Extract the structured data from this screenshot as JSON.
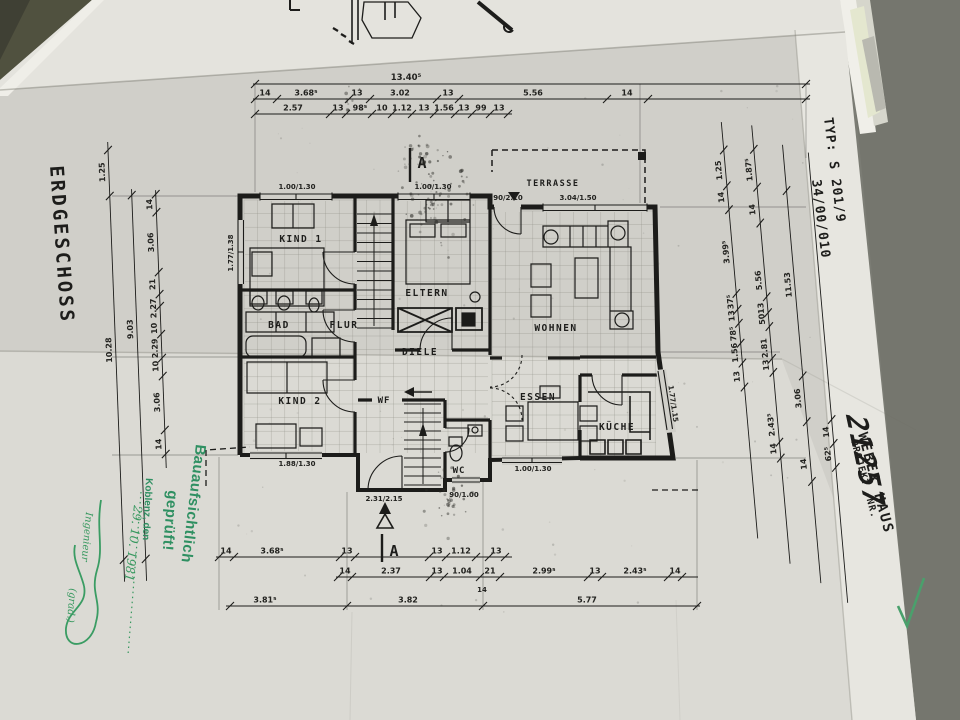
{
  "sheet": {
    "floor_label": "ERDGESCHOSS",
    "typ_line1": "TYP: S 201/9",
    "typ_line2": "34/00/010",
    "brand_name": "WEBER HAUS",
    "project_label": "PROJEKT -NR.",
    "project_no": "21257"
  },
  "rooms": {
    "kind1": "KIND 1",
    "eltern": "ELTERN",
    "bad": "BAD",
    "flur": "FLUR",
    "diele": "DIELE",
    "kind2": "KIND 2",
    "wf": "WF",
    "wc": "WC",
    "essen": "ESSEN",
    "kueche": "KÜCHE",
    "wohnen": "WOHNEN",
    "terrasse": "TERRASSE"
  },
  "openings": {
    "kind1_top": "1.00/1.30",
    "eltern_top": "1.00/1.30",
    "terrace_door": "90/2.10",
    "wohnen_window": "3.04/1.50",
    "kind1_left": "1.77/1.38",
    "kind2_bottom": "1.88/1.30",
    "entry_door": "2.31/2.15",
    "wc_door": "90/1.00",
    "essen_bottom": "1.00/1.30",
    "kueche_diag": "1.77/1.15"
  },
  "section": {
    "marker": "A"
  },
  "dims": {
    "top_total": "13.40⁵",
    "top_row": [
      "14",
      "3.68⁵",
      "13",
      "3.02",
      "13",
      "5.56",
      "14"
    ],
    "top_sub": [
      "2.57",
      "13",
      "98⁵",
      "10",
      "1.12",
      "13",
      "1.56",
      "13",
      "99",
      "13"
    ],
    "bottom_row1": [
      "14",
      "3.68⁵",
      "13",
      "13",
      "1.12",
      "13"
    ],
    "bottom_row2": [
      "14",
      "2.37",
      "13",
      "1.04",
      "21",
      "2.99⁵",
      "13",
      "2.43⁵",
      "14"
    ],
    "bottom_row2_extra": "14",
    "bottom_row3": [
      "3.81⁵",
      "3.82",
      "5.77"
    ],
    "left_col1": [
      "1.25",
      "10.28"
    ],
    "left_col2": [
      "9.03"
    ],
    "left_col3": [
      "14",
      "3.06",
      "21",
      "2.27",
      "10",
      "2.29",
      "10",
      "3.06",
      "14"
    ],
    "right_col1": [
      "1.25",
      "14",
      "3.99⁵",
      "37⁵",
      "13",
      "78⁵",
      "1.56",
      "13"
    ],
    "right_col2": [
      "1.87⁵",
      "14",
      "5.56",
      "13",
      "50",
      "2.81",
      "13",
      "2.43⁵",
      "14"
    ],
    "right_col3": [
      "11.53",
      "3.06",
      "14"
    ],
    "right_col4": [
      "14",
      "62⁵"
    ]
  },
  "stamp": {
    "line1": "Bauaufsichtlich",
    "line2": "geprüft!",
    "line3": "Koblenz, den",
    "date": "29. 10. 1981",
    "sig_note": "Ingenieur",
    "grad": "(grad.)"
  }
}
